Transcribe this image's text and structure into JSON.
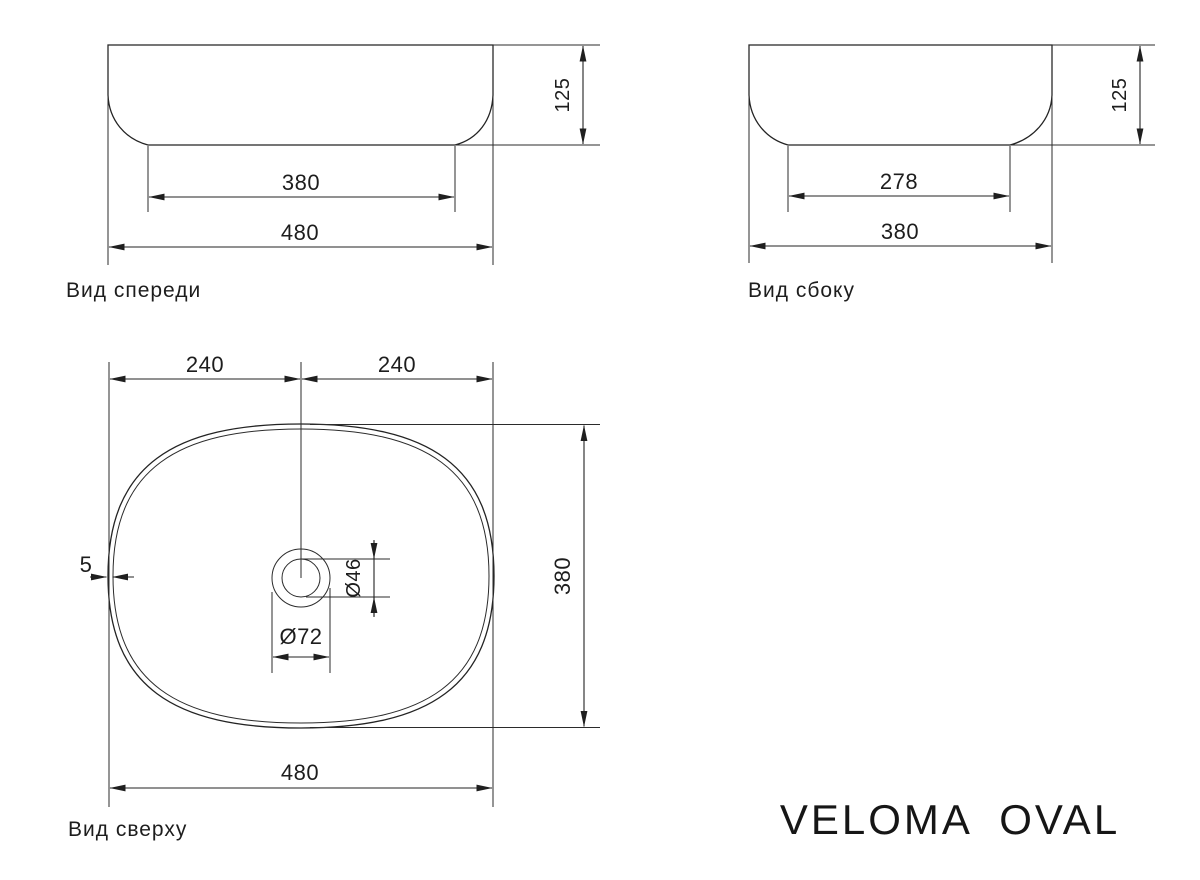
{
  "title": "VELOMA OVAL",
  "views": {
    "front": {
      "label": "Вид спереди",
      "dims": {
        "overall_width": "480",
        "base_width": "380",
        "height": "125"
      }
    },
    "side": {
      "label": "Вид сбоку",
      "dims": {
        "overall_depth": "380",
        "base_depth": "278",
        "height": "125"
      }
    },
    "top": {
      "label": "Вид сверху",
      "dims": {
        "center_to_edge_left": "240",
        "center_to_edge_right": "240",
        "overall_width": "480",
        "overall_depth": "380",
        "wall_thickness": "5",
        "drain_outer": "Ø72",
        "drain_inner": "Ø46"
      }
    }
  }
}
